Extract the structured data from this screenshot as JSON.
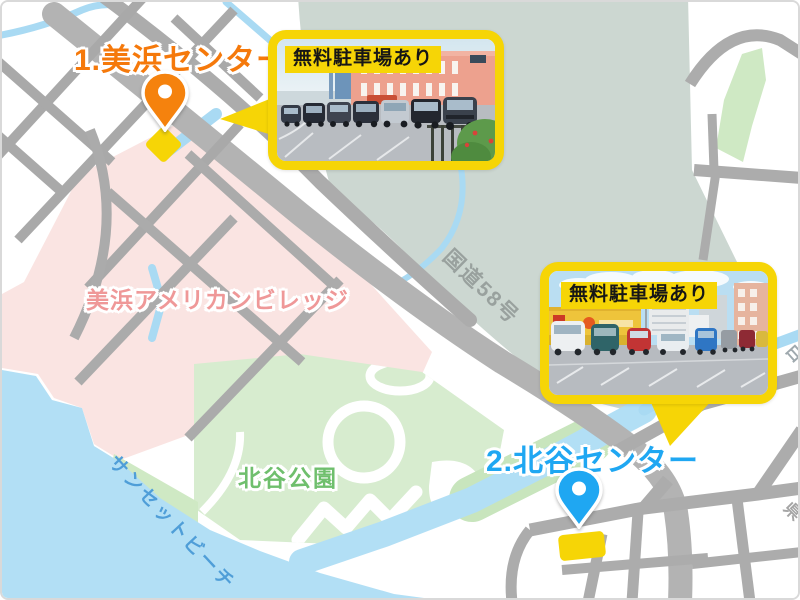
{
  "canvas": {
    "width": 800,
    "height": 600
  },
  "theme": {
    "accent_orange": "#f5790b",
    "accent_blue": "#1fa7f2",
    "highlight_yellow": "#f6d506",
    "area_pink": "#fae4e2",
    "area_pink_label": "#ef9898",
    "park_green": "#d7eccf",
    "park_label_green": "#6fbf6d",
    "water_blue": "#b2dff5",
    "water_label_blue": "#4f9ed8",
    "base_sage": "#ccd7d1",
    "road_gray": "#b3b3b3",
    "road_label_gray": "#99a19e"
  },
  "markers": [
    {
      "id": "mihama-center",
      "label": "1.美浜センター",
      "pin_color": "#f5820d",
      "building_marker": "yellow-diamond-icon"
    },
    {
      "id": "chatan-center",
      "label": "2.北谷センター",
      "pin_color": "#1fa7f2",
      "building_marker": "yellow-rect-icon"
    }
  ],
  "callouts": [
    {
      "id": "mihama-parking",
      "badge": "無料駐車場あり"
    },
    {
      "id": "chatan-parking",
      "badge": "無料駐車場あり"
    }
  ],
  "map_labels": {
    "american_village": "美浜アメリカンビレッジ",
    "chatan_park": "北谷公園",
    "sunset_beach": "サンセットビーチ",
    "route58": "国道58号",
    "river_partial": "白",
    "road_partial": "県"
  }
}
